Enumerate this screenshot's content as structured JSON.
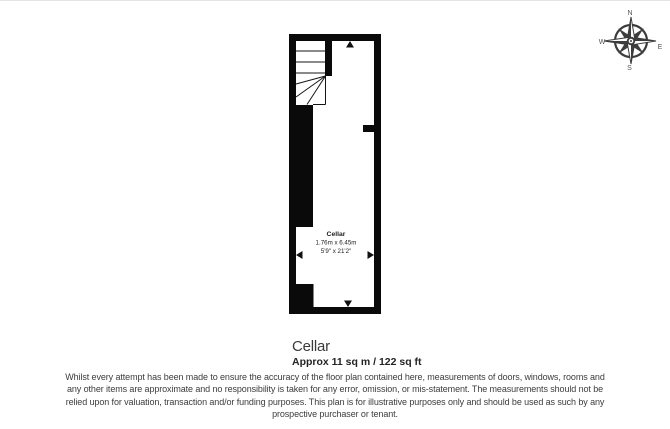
{
  "floorplan": {
    "room_label": "Cellar",
    "room_dimensions_metric": "1.76m x 6.45m",
    "room_dimensions_imperial": "5'9\" x 21'2\""
  },
  "compass": {
    "north": "N",
    "south": "S",
    "east": "E",
    "west": "W"
  },
  "summary": {
    "room_name": "Cellar",
    "area_text": "Approx 11 sq m / 122 sq ft"
  },
  "disclaimer": {
    "lines": [
      "Whilst every attempt has been made to ensure the accuracy of the floor plan contained here, measurements of doors, windows, rooms and",
      "any other items are approximate and no responsibility is taken for any error, omission, or mis-statement. The measurements should not be",
      "relied upon for valuation, transaction and/or funding purposes. This plan is for illustrative purposes only and should be used as such by any",
      "prospective purchaser or tenant."
    ]
  },
  "colors": {
    "wall": "#0a0a0a",
    "compass": "#3d3d3d",
    "text_primary": "#3a3a3a"
  }
}
